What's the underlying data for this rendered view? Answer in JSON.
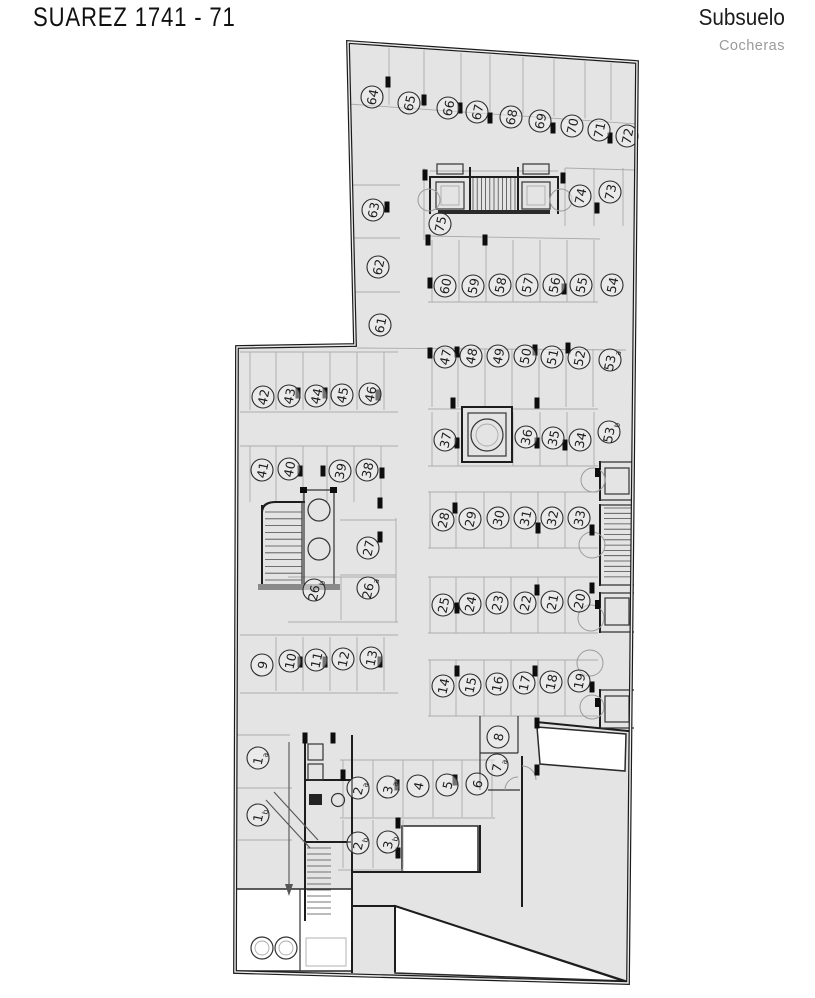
{
  "header": {
    "title": "SUAREZ 1741 - 71",
    "level": "Subsuelo",
    "sublabel": "Cocheras"
  },
  "colors": {
    "floor": "#e4e4e4",
    "wall": "#1d1d1d",
    "subtitle_gray": "#9a9a9a"
  },
  "plan": {
    "spots": [
      {
        "n": "64",
        "x": 372,
        "y": 97
      },
      {
        "n": "65",
        "x": 409,
        "y": 103
      },
      {
        "n": "66",
        "x": 448,
        "y": 108
      },
      {
        "n": "67",
        "x": 477,
        "y": 112
      },
      {
        "n": "68",
        "x": 511,
        "y": 117
      },
      {
        "n": "69",
        "x": 540,
        "y": 121
      },
      {
        "n": "70",
        "x": 572,
        "y": 126
      },
      {
        "n": "71",
        "x": 599,
        "y": 130
      },
      {
        "n": "72",
        "x": 627,
        "y": 136
      },
      {
        "n": "73",
        "x": 610,
        "y": 192
      },
      {
        "n": "74",
        "x": 580,
        "y": 196
      },
      {
        "n": "75",
        "x": 440,
        "y": 224
      },
      {
        "n": "63",
        "x": 373,
        "y": 210
      },
      {
        "n": "62",
        "x": 378,
        "y": 267
      },
      {
        "n": "61",
        "x": 380,
        "y": 325
      },
      {
        "n": "60",
        "x": 445,
        "y": 286
      },
      {
        "n": "59",
        "x": 473,
        "y": 286
      },
      {
        "n": "58",
        "x": 500,
        "y": 285
      },
      {
        "n": "57",
        "x": 527,
        "y": 285
      },
      {
        "n": "56",
        "x": 554,
        "y": 285
      },
      {
        "n": "55",
        "x": 581,
        "y": 285
      },
      {
        "n": "54",
        "x": 612,
        "y": 285
      },
      {
        "n": "47",
        "x": 445,
        "y": 357
      },
      {
        "n": "48",
        "x": 471,
        "y": 356
      },
      {
        "n": "49",
        "x": 498,
        "y": 356
      },
      {
        "n": "50",
        "x": 525,
        "y": 356
      },
      {
        "n": "51",
        "x": 552,
        "y": 357
      },
      {
        "n": "52",
        "x": 579,
        "y": 358
      },
      {
        "n": "53",
        "s": "a",
        "x": 610,
        "y": 360
      },
      {
        "n": "37",
        "x": 445,
        "y": 440
      },
      {
        "n": "36",
        "x": 526,
        "y": 437
      },
      {
        "n": "35",
        "x": 553,
        "y": 438
      },
      {
        "n": "34",
        "x": 580,
        "y": 440
      },
      {
        "n": "53",
        "s": "b",
        "x": 609,
        "y": 432
      },
      {
        "n": "42",
        "x": 263,
        "y": 397
      },
      {
        "n": "43",
        "x": 289,
        "y": 396
      },
      {
        "n": "44",
        "x": 316,
        "y": 396
      },
      {
        "n": "45",
        "x": 342,
        "y": 395
      },
      {
        "n": "46",
        "x": 370,
        "y": 394
      },
      {
        "n": "41",
        "x": 262,
        "y": 470
      },
      {
        "n": "40",
        "x": 289,
        "y": 469
      },
      {
        "n": "39",
        "x": 340,
        "y": 471
      },
      {
        "n": "38",
        "x": 367,
        "y": 470
      },
      {
        "n": "28",
        "x": 443,
        "y": 520
      },
      {
        "n": "29",
        "x": 470,
        "y": 519
      },
      {
        "n": "30",
        "x": 498,
        "y": 518
      },
      {
        "n": "31",
        "x": 525,
        "y": 518
      },
      {
        "n": "32",
        "x": 552,
        "y": 518
      },
      {
        "n": "33",
        "x": 579,
        "y": 518
      },
      {
        "n": "27",
        "x": 368,
        "y": 548
      },
      {
        "n": "26",
        "s": "b",
        "x": 314,
        "y": 590
      },
      {
        "n": "26",
        "s": "a",
        "x": 368,
        "y": 588
      },
      {
        "n": "25",
        "x": 443,
        "y": 605
      },
      {
        "n": "24",
        "x": 470,
        "y": 604
      },
      {
        "n": "23",
        "x": 497,
        "y": 603
      },
      {
        "n": "22",
        "x": 525,
        "y": 603
      },
      {
        "n": "21",
        "x": 552,
        "y": 602
      },
      {
        "n": "20",
        "x": 579,
        "y": 601
      },
      {
        "n": "9",
        "x": 262,
        "y": 665
      },
      {
        "n": "10",
        "x": 290,
        "y": 661
      },
      {
        "n": "11",
        "x": 316,
        "y": 660
      },
      {
        "n": "12",
        "x": 343,
        "y": 659
      },
      {
        "n": "13",
        "x": 371,
        "y": 658
      },
      {
        "n": "14",
        "x": 443,
        "y": 686
      },
      {
        "n": "15",
        "x": 470,
        "y": 685
      },
      {
        "n": "16",
        "x": 497,
        "y": 684
      },
      {
        "n": "17",
        "x": 524,
        "y": 683
      },
      {
        "n": "18",
        "x": 551,
        "y": 682
      },
      {
        "n": "19",
        "x": 579,
        "y": 681
      },
      {
        "n": "8",
        "x": 498,
        "y": 737
      },
      {
        "n": "7",
        "s": "a",
        "x": 497,
        "y": 765
      },
      {
        "n": "1",
        "s": "a",
        "x": 258,
        "y": 758
      },
      {
        "n": "1",
        "s": "b",
        "x": 258,
        "y": 815
      },
      {
        "n": "2",
        "s": "a",
        "x": 358,
        "y": 788
      },
      {
        "n": "3",
        "s": "a",
        "x": 388,
        "y": 787
      },
      {
        "n": "4",
        "x": 418,
        "y": 786
      },
      {
        "n": "5",
        "x": 447,
        "y": 785
      },
      {
        "n": "6",
        "x": 477,
        "y": 784
      },
      {
        "n": "2",
        "s": "b",
        "x": 358,
        "y": 843
      },
      {
        "n": "3",
        "s": "b",
        "x": 388,
        "y": 842
      }
    ]
  }
}
